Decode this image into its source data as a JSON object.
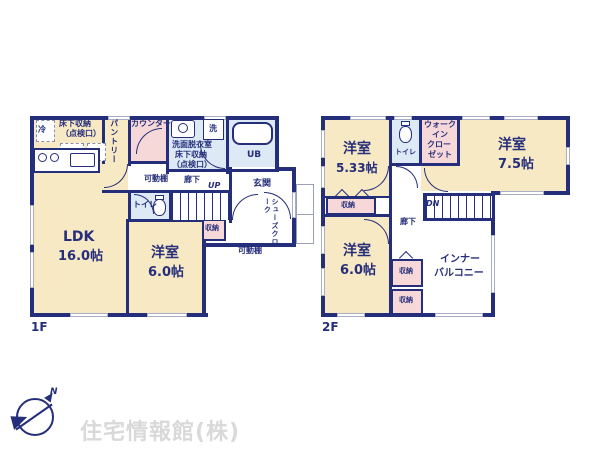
{
  "colors": {
    "wall": "#252e7a",
    "room_cream": "#f8e9c5",
    "closet_pink": "#f7d8d9",
    "wet_area_blue": "#dde9f5",
    "watermark_gray": "#d9d9d9"
  },
  "floor1": {
    "floor_label": "1F",
    "ldk_name": "LDK",
    "ldk_area": "16.0帖",
    "bedroom_name": "洋室",
    "bedroom_area": "6.0帖",
    "fridge": "冷",
    "underfloor_line1": "床下収納",
    "underfloor_line2": "（点検口）",
    "pantry": "パントリー",
    "counter": "カウンター",
    "washroom_line1": "洗面脱衣室",
    "washroom_line2": "床下収納",
    "washroom_line3": "（点検口）",
    "washer": "洗",
    "unit_bath": "UB",
    "shelf_hall": "可動棚",
    "hallway": "廊下",
    "toilet": "トイレ",
    "stairs_up": "UP",
    "entrance": "玄関",
    "shoe_closet": "シューズクローク",
    "storage": "収納",
    "shelf_entry": "可動棚"
  },
  "floor2": {
    "floor_label": "2F",
    "bedroom533_name": "洋室",
    "bedroom533_area": "5.33帖",
    "bedroom75_name": "洋室",
    "bedroom75_area": "7.5帖",
    "bedroom60_name": "洋室",
    "bedroom60_area": "6.0帖",
    "toilet": "トイレ",
    "wic_line1": "ウォーク",
    "wic_line2": "イン",
    "wic_line3": "クロー",
    "wic_line4": "ゼット",
    "storage_a": "収納",
    "hallway": "廊下",
    "stairs_down": "DN",
    "storage_b": "収納",
    "storage_c": "収納",
    "balcony_line1": "インナー",
    "balcony_line2": "バルコニー"
  },
  "footer": {
    "watermark": "住宅情報館(株)",
    "compass_north": "N"
  }
}
